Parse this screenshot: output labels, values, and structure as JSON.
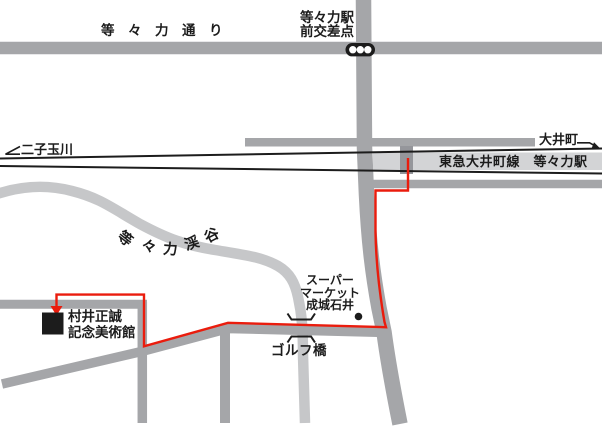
{
  "labels": {
    "todoroki_dori": "等々力通り",
    "intersection": {
      "line1": "等々力駅",
      "line2": "前交差点"
    },
    "futako_tamagawa": "二子玉川",
    "oimachi": "大井町",
    "station_box": "東急大井町線　等々力駅",
    "valley": {
      "full": "等々力渓谷",
      "chars": [
        "等",
        "々",
        "力",
        "渓",
        "谷"
      ]
    },
    "supermarket": {
      "line1": "スーパー",
      "line2": "マーケット",
      "line3": "成城石井"
    },
    "golf_bridge": "ゴルフ橋",
    "museum": {
      "line1": "村井正誠",
      "line2": "記念美術館"
    }
  },
  "icons": {
    "traffic_light": "traffic-light-signal",
    "bridge": "bridge-brackets",
    "museum_marker": "black-square-marker",
    "supermarket_marker": "black-dot-marker",
    "rail_arrow_left": "arrow-down-left",
    "rail_arrow_right": "arrow-down-right",
    "route_arrow": "arrow-down"
  },
  "colors": {
    "ink": "#1c1c1c",
    "road": "#a5a6a9",
    "valley": "#c6c7c9",
    "station_box": "#d3d4d6",
    "entrance": "#95969b",
    "route": "#ea1c0d"
  }
}
